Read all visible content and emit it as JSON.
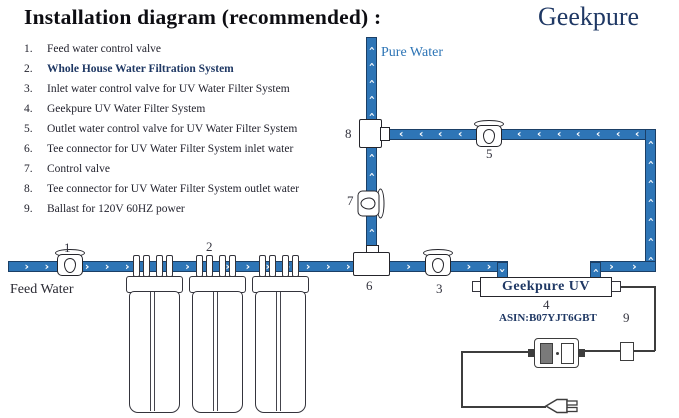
{
  "header": {
    "title": "Installation diagram (recommended) :",
    "brand": "Geekpure"
  },
  "legend": {
    "items": [
      {
        "num": "1.",
        "text": "Feed water control valve"
      },
      {
        "num": "2.",
        "text": "Whole House Water Filtration System"
      },
      {
        "num": "3.",
        "text": "Inlet water control valve for UV Water Filter System"
      },
      {
        "num": "4.",
        "text": "Geekpure UV Water Filter System"
      },
      {
        "num": "5.",
        "text": "Outlet water control valve for UV Water Filter System"
      },
      {
        "num": "6.",
        "text": "Tee connector for UV Water Filter System  inlet water"
      },
      {
        "num": "7.",
        "text": "Control valve"
      },
      {
        "num": "8.",
        "text": "Tee connector for UV Water Filter System  outlet water"
      },
      {
        "num": "9.",
        "text": "Ballast for 120V 60HZ power"
      }
    ]
  },
  "diagram": {
    "labels": {
      "pure_water": "Pure Water",
      "feed_water": "Feed Water",
      "uv_unit": "Geekpure UV",
      "asin": "ASIN:B07YJT6GBT"
    },
    "callouts": {
      "c1": "1",
      "c2": "2",
      "c3": "3",
      "c4": "4",
      "c5": "5",
      "c6": "6",
      "c7": "7",
      "c8": "8",
      "c9": "9"
    }
  },
  "icons": {
    "flow_arrow": "›"
  },
  "colors": {
    "pipe": "#2E75B6",
    "pipe_border": "#1B3F66",
    "brand": "#1F3864",
    "label_blue": "#2E75B6",
    "ink": "#23232e",
    "wire": "#3d3d3d"
  }
}
